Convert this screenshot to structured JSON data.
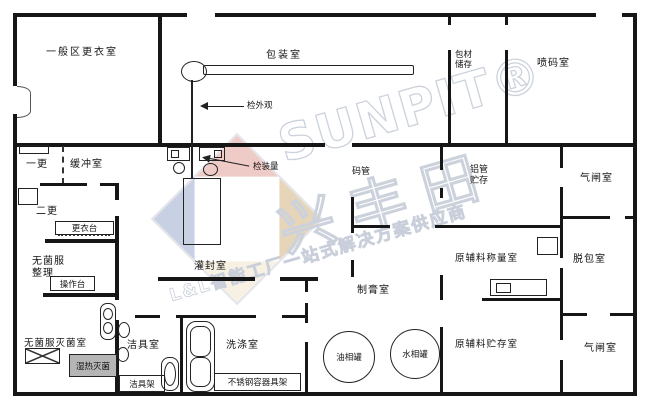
{
  "watermark": {
    "brand": "SUNPIT®",
    "brand_cn": "兴丰田",
    "slogan": "L&L智能工厂一站式解决方案供应商"
  },
  "rooms": {
    "general_changing": "一般区更衣室",
    "packaging": "包装室",
    "packing_material_storage": "包材储存",
    "inkjet_coding": "喷码室",
    "first_changing": "一更",
    "buffer": "缓冲室",
    "second_changing": "二更",
    "sterile_clothes_sorting": "无菌服整理",
    "sterile_clothes_sterilizing": "无菌服灭菌室",
    "cleaning_tools": "洁具室",
    "washing": "洗涤室",
    "filling_sealing": "灌封室",
    "tube_arranging": "码管",
    "aluminum_tube_storage": "铝管贮存",
    "raw_material_weighing": "原辅料称量室",
    "raw_material_storage": "原辅料贮存室",
    "depacking": "脱包室",
    "airlock_top": "气闸室",
    "airlock_bottom": "气闸室",
    "paste_making": "制膏室"
  },
  "fixtures": {
    "changing_table": "更衣台",
    "operating_table": "操作台",
    "moist_heat_sterilizer": "湿热灭菌",
    "cleaning_rack": "洁具架",
    "stainless_container_rack": "不锈钢容器具架",
    "oil_phase_tank": "油相罐",
    "water_phase_tank": "水相罐"
  },
  "annotations": {
    "inspect_appearance": "检外观",
    "inspect_fill_amount": "检装量"
  },
  "colors": {
    "wall": "#161616",
    "watermark_gray": "#ccd2dc",
    "logo_red": "#e7b6ae",
    "logo_blue": "#b2bdd8",
    "logo_orange": "#dec49c",
    "sterilizer_box_gray": "#b5b5b5"
  }
}
